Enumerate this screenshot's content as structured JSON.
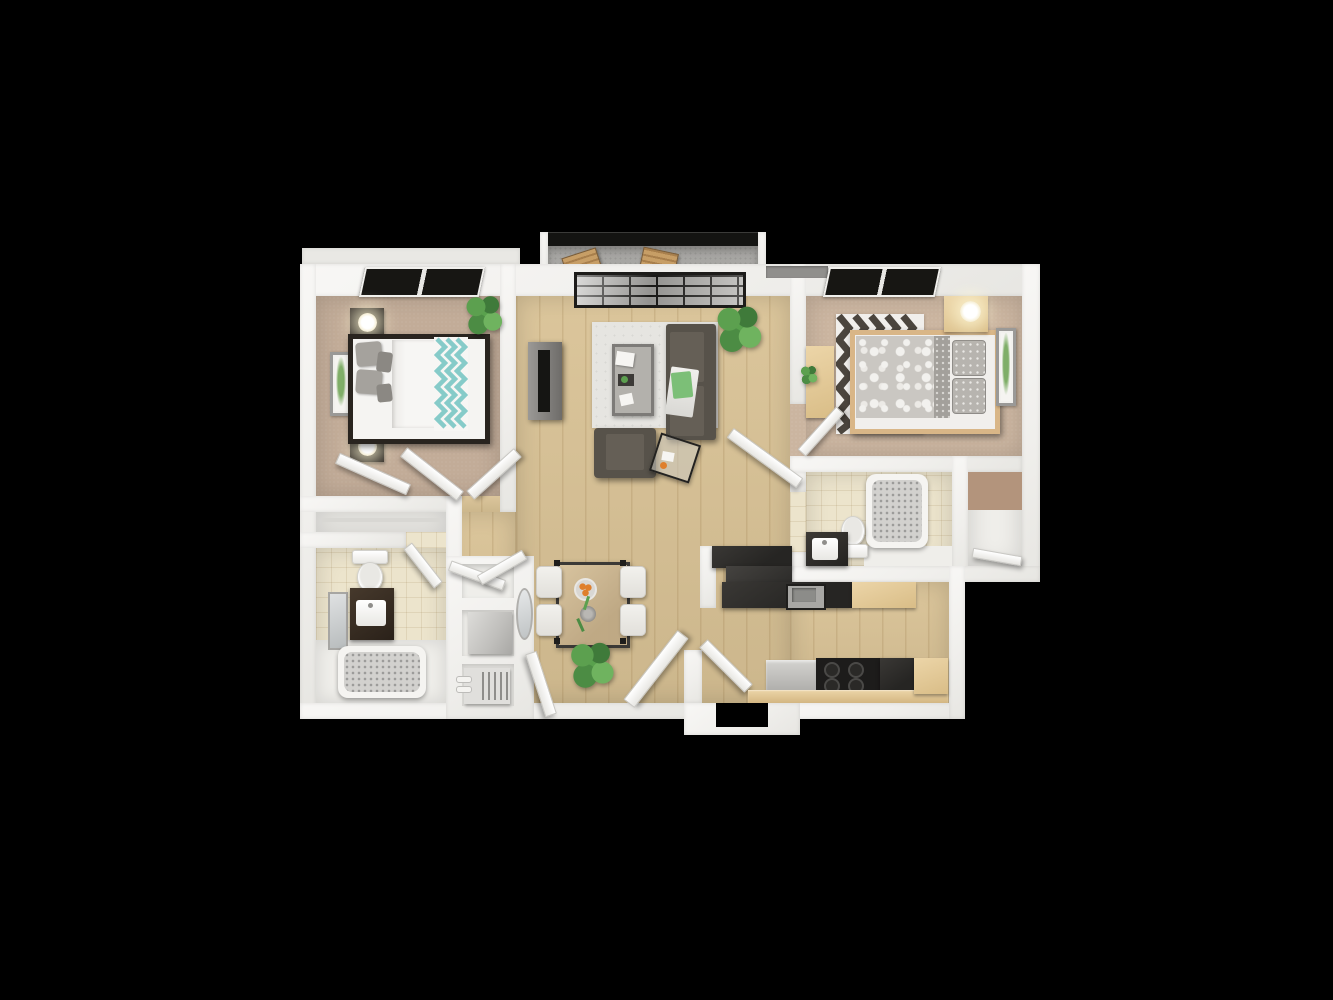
{
  "scene": {
    "type": "3d-floor-plan-render",
    "view": "top-down isometric apartment floor plan",
    "background": "#000000"
  },
  "palette": {
    "bg": "#000000",
    "wall": "#f4f3f0",
    "wall_shade": "#e6e5e1",
    "wood": "#d9c295",
    "carpet_a": "#c2ac98",
    "carpet_b": "#cbb5a0",
    "tile": "#ece4cc",
    "concrete": "#a7a6a3",
    "rail_dark": "#141412",
    "glass_frame": "#1d1c1a",
    "glass": "#b4b3b0",
    "window_dark": "#171613",
    "sofa": "#57524a",
    "sofa_light": "#655f56",
    "rug": "#e6e5e1",
    "bed1_frame": "#29241f",
    "mattress": "#f5f4f2",
    "pillow_gray": "#a5a29d",
    "teal": "#86cbc9",
    "bed2_frame": "#d9b687",
    "duvet_gray": "#cac7c2",
    "chevron_dark": "#4b453e",
    "wood_furn": "#e5cb9e",
    "counter_dark": "#2f2e2b",
    "stainless": "#a8a7a4",
    "stove_black": "#1d1c1b",
    "vanity_dark": "#332c24",
    "plant_green": "#5ca04f",
    "plant_green_dark": "#3f7a3a",
    "orange": "#df7f2c",
    "closet_brown": "#b3947c",
    "appliance_gray": "#c8c7c4"
  },
  "rooms": [
    {
      "id": "bedroom-left",
      "floor": "carpet_a"
    },
    {
      "id": "living-room",
      "floor": "wood"
    },
    {
      "id": "bedroom-right",
      "floor": "carpet_b"
    },
    {
      "id": "bathroom-right",
      "floor": "tile"
    },
    {
      "id": "closet-right",
      "floor": "wall"
    },
    {
      "id": "bathroom-left",
      "floor": "tile"
    },
    {
      "id": "hall-dining",
      "floor": "wood"
    },
    {
      "id": "kitchen",
      "floor": "wood"
    },
    {
      "id": "balcony",
      "floor": "concrete"
    }
  ],
  "objects": {
    "bedroom_left": [
      "double-bed-dark-frame",
      "teal-chevron-throw",
      "gray-pillows",
      "nightstand-with-lamp-top",
      "nightstand-with-lamp-bottom",
      "wall-art",
      "potted-plant",
      "closet-doors-open",
      "room-door-open",
      "window"
    ],
    "living_room": [
      "sofa-dark-gray",
      "area-rug",
      "coffee-table-glass",
      "armchair",
      "glass-side-table",
      "tv-console",
      "potted-plant",
      "sliding-glass-door"
    ],
    "balcony": [
      "railing",
      "wood-chair-1",
      "wood-chair-2"
    ],
    "bedroom_right": [
      "bed-light-wood-frame",
      "patterned-duvet",
      "chevron-rug",
      "nightstand-with-lamp",
      "desk",
      "wall-art",
      "window",
      "room-door-open"
    ],
    "bathroom_right": [
      "bathtub",
      "toilet",
      "dark-vanity-with-sink",
      "door-open"
    ],
    "closet_right": [
      "closet-shelf"
    ],
    "bathroom_left": [
      "toilet",
      "dark-vanity-with-sink",
      "wall-mirror",
      "bathtub",
      "door-open"
    ],
    "hall_dining": [
      "dining-table-glass",
      "dining-chairs-4",
      "fruit-bowl",
      "vase",
      "potted-plant",
      "oval-mirror",
      "linen-closet-doors",
      "washer-unit",
      "water-heater",
      "entry-doors-open"
    ],
    "kitchen": [
      "counter-peninsula-dark",
      "sink-stainless",
      "upper-wood-cabinet",
      "dishwasher",
      "stove-4-burners",
      "lower-wood-cabinets"
    ]
  }
}
